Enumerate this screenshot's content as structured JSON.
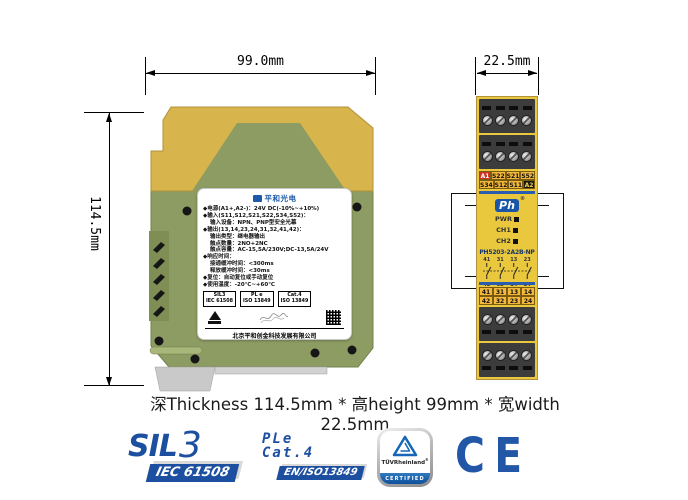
{
  "dims": {
    "width": "99.0mm",
    "height": "114.5mm",
    "depth": "22.5mm"
  },
  "caption": "深Thickness 114.5mm * 高height 99mm * 宽width 22.5mm",
  "side_label": {
    "logo": "平和光电",
    "spec": [
      "◆电源(A1+,A2-)：24V DC(-10%~+10%)",
      "◆输入(S11,S12,S21,S22,S34,S52)：",
      "输入设备：NPN、PNP型安全光幕",
      "◆输出(13,14,23,24,31,32,41,42)：",
      "输出类型：继电器输出",
      "触点数量：2NO+2NC",
      "触点容量：AC-15,5A/230V;DC-13,5A/24V",
      "◆响应时间：",
      "接通缓冲时间：<300ms",
      "释放缓冲时间：<30ms",
      "◆复位：自动复位或手动复位",
      "◆使用温度：-20℃~+60℃"
    ],
    "certs": [
      [
        "SIL3",
        "IEC 61508"
      ],
      [
        "PL e",
        "ISO 13849"
      ],
      [
        "Cat.4",
        "ISO 13849"
      ]
    ],
    "company": "北京平和创金科技发展有限公司",
    "contact": "技术支持：400-711-0741  网址：www.bjpinghe.com"
  },
  "front": {
    "top_terms": [
      [
        "A1",
        "S22",
        "S21",
        "S52"
      ],
      [
        "S34",
        "S12",
        "S11",
        "A2"
      ]
    ],
    "logo": "Ph",
    "logo_reg": "®",
    "leds": [
      "PWR",
      "CH1",
      "CH2"
    ],
    "model": "PH5203-2A2B-NP",
    "diag_top": [
      "41",
      "31",
      "13",
      "23"
    ],
    "diag_bottom": [
      "42",
      "32",
      "14",
      "24"
    ],
    "bottom_terms": [
      [
        "41",
        "31",
        "13",
        "14"
      ],
      [
        "42",
        "32",
        "23",
        "24"
      ]
    ]
  },
  "badges": {
    "sil": {
      "word": "SIL",
      "num": "3",
      "sub": "IEC 61508"
    },
    "ple": {
      "l1": "PLe",
      "l2": "Cat.4",
      "sub": "EN/ISO13849"
    },
    "tuv": {
      "brand": "TÜVRheinland",
      "reg": "®",
      "sub": "CERTIFIED"
    },
    "ce": "CE"
  },
  "colors": {
    "brand_blue": "#1d4fa1",
    "module_cap_yellow": "#d7b44c",
    "module_green": "#8d9c63",
    "front_yellow": "#e9c83e",
    "band_blue": "#2a5db0",
    "terminal_dark": "#3c3c3c",
    "a1_red": "#d03126"
  }
}
